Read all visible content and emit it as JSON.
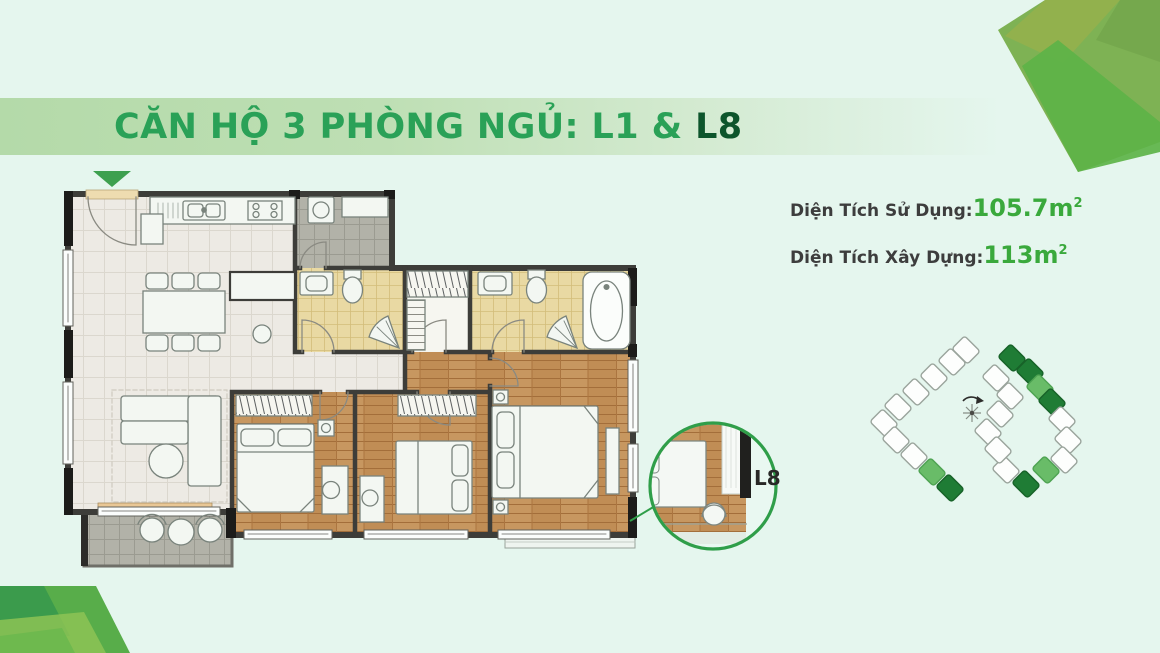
{
  "page": {
    "background_color": "#e5f6ee"
  },
  "header": {
    "title_main": "CĂN HỘ 3 PHÒNG NGỦ: L1 & ",
    "title_highlight": "L8",
    "title_color": "#2aa157",
    "title_highlight_color": "#0d552c",
    "banner_color": "#b4daa9"
  },
  "stats": {
    "items": [
      {
        "label": "Diện Tích Sử Dụng:",
        "value": "105.7m",
        "sup": "2"
      },
      {
        "label": "Diện Tích Xây Dựng:",
        "value": "113m",
        "sup": "2"
      }
    ],
    "label_color": "#3d3d3d",
    "value_color": "#3aa93c"
  },
  "floor_plan": {
    "entrance_marker_color": "#3da04f",
    "rooms": [
      "living-dining",
      "kitchen",
      "utility",
      "bathroom-1",
      "walk-in-closet",
      "master-bathroom",
      "hallway",
      "bedroom-1",
      "bedroom-2",
      "master-bedroom",
      "balcony"
    ]
  },
  "callout": {
    "label": "L8",
    "ring_color": "#2f9e49"
  },
  "site_plan": {
    "unit_outline_color": "#9aa49c",
    "highlight_light": "#69bc68",
    "highlight_dark": "#1f7c35"
  }
}
